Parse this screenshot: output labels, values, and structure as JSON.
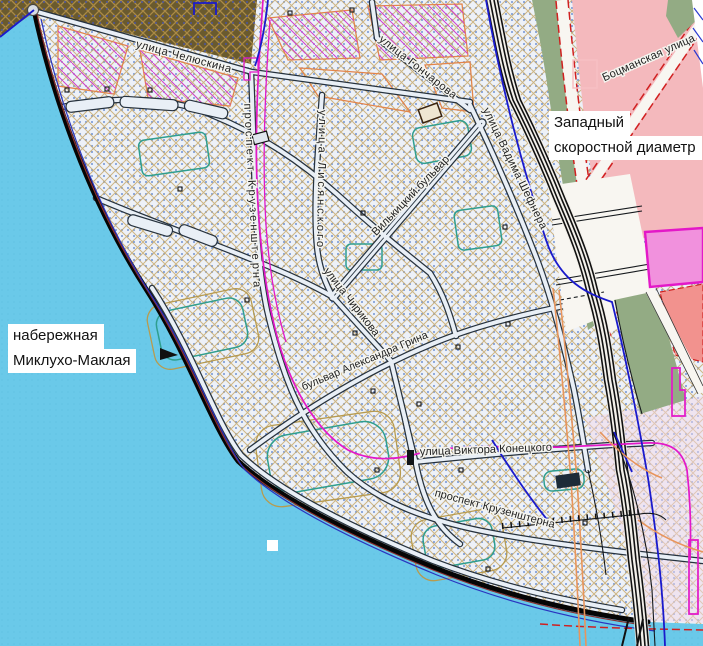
{
  "map": {
    "title": "Urban plan map — Vasilyevsky Island west shore",
    "street_labels": [
      {
        "id": "chelyuskina",
        "text": "улица Челюскина"
      },
      {
        "id": "goncharova",
        "text": "улица Гончарова"
      },
      {
        "id": "botsmanskaya",
        "text": "Боцманская улица"
      },
      {
        "id": "kruzenshterna-west",
        "text": "проспект Крузенштерна"
      },
      {
        "id": "lisyanskogo",
        "text": "улица Лисянского"
      },
      {
        "id": "vilkitsky",
        "text": "Вилькицкий бульвар"
      },
      {
        "id": "shefnera",
        "text": "улица Вадима Шефнера"
      },
      {
        "id": "chirikova",
        "text": "улица Чирикова"
      },
      {
        "id": "grina",
        "text": "бульвар Александра Грина"
      },
      {
        "id": "konetskogo",
        "text": "улица Виктора Конецкого"
      },
      {
        "id": "kruzenshterna-south",
        "text": "проспект Крузенштерна"
      }
    ],
    "callouts": [
      {
        "id": "naberezhnaya",
        "line1": "набережная",
        "line2": "Миклухо-Маклая"
      },
      {
        "id": "zsd",
        "line1": "Западный",
        "line2": "скоростной диаметр"
      }
    ],
    "colors": {
      "water": "#6AC9E9",
      "water_dots": "#58BADE",
      "land_base": "#EDF1F8",
      "land_dots": "#4D78C8",
      "hatch_tan": "#C6A665",
      "built_brown": "#6A5A2E",
      "brown_hatch": "#AB8A45",
      "brown_dots": "#4A55A0",
      "block_orange": "#E2854A",
      "block_magenta": "#CF3ECF",
      "district_pink": "#F4B9BD",
      "bright_pink": "#F191DD",
      "salmon": "#F2928E",
      "green_zone": "#93AB84",
      "road_fill": "#E9EFF6",
      "road_casing": "#26323E",
      "embankment": "#050505",
      "highway": "#111111",
      "line_magenta": "#E318C8",
      "line_blue": "#1A1ACC",
      "line_teal": "#2F9E8F",
      "line_orange": "#E8955C",
      "line_red": "#D02020",
      "shore_red": "#8A3030",
      "shore_blue": "#2A35C0",
      "label_ink": "#1F1F1F",
      "callout_bg": "#FFFFFF",
      "se_tint": "#F2D8E8"
    }
  }
}
